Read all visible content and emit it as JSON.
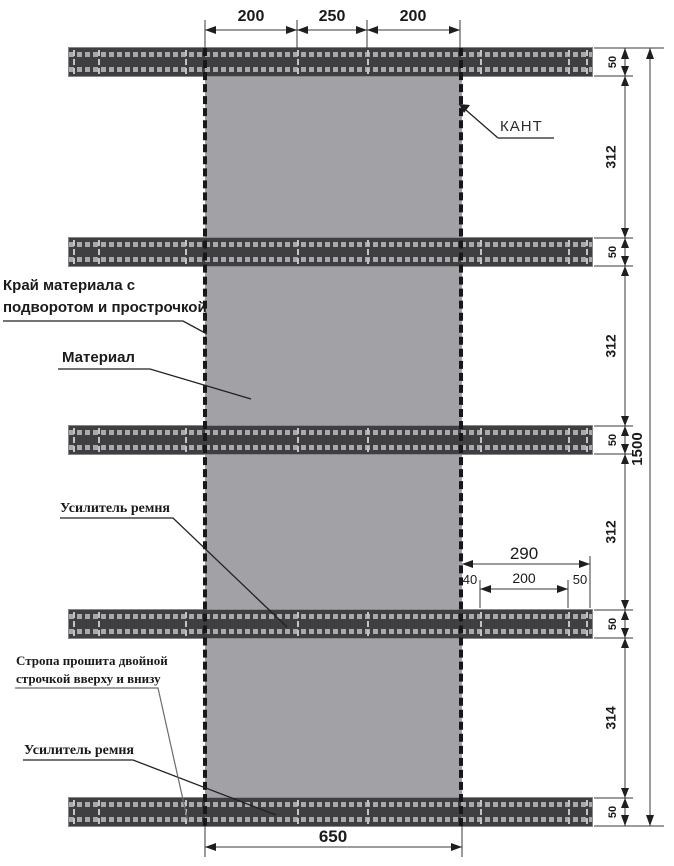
{
  "labels": {
    "kant": "КАНТ",
    "material_edge_line1": "Край материала с",
    "material_edge_line2": "подворотом и прострочкой",
    "material": "Материал",
    "belt_reinforcement_upper": "Усилитель ремня",
    "strap_stitching_line1": "Стропа прошита двойной",
    "strap_stitching_line2": "строчкой вверху и внизу",
    "belt_reinforcement_lower": "Усилитель ремня"
  },
  "dimensions": {
    "top": [
      "200",
      "250",
      "200"
    ],
    "bottom_width": "650",
    "overall_height": "1500",
    "strap_heights": [
      "50",
      "50",
      "50",
      "50",
      "50"
    ],
    "gaps": [
      "312",
      "312",
      "312",
      "314"
    ],
    "strap_extension": {
      "total": "290",
      "left": "40",
      "middle": "200",
      "right": "50"
    }
  },
  "colors": {
    "material": "#a2a2a6",
    "strap": "#3f3f41",
    "stitch": "#c3c3c7",
    "edge_stitch": "#18181a",
    "line": "#2a2a2a"
  }
}
